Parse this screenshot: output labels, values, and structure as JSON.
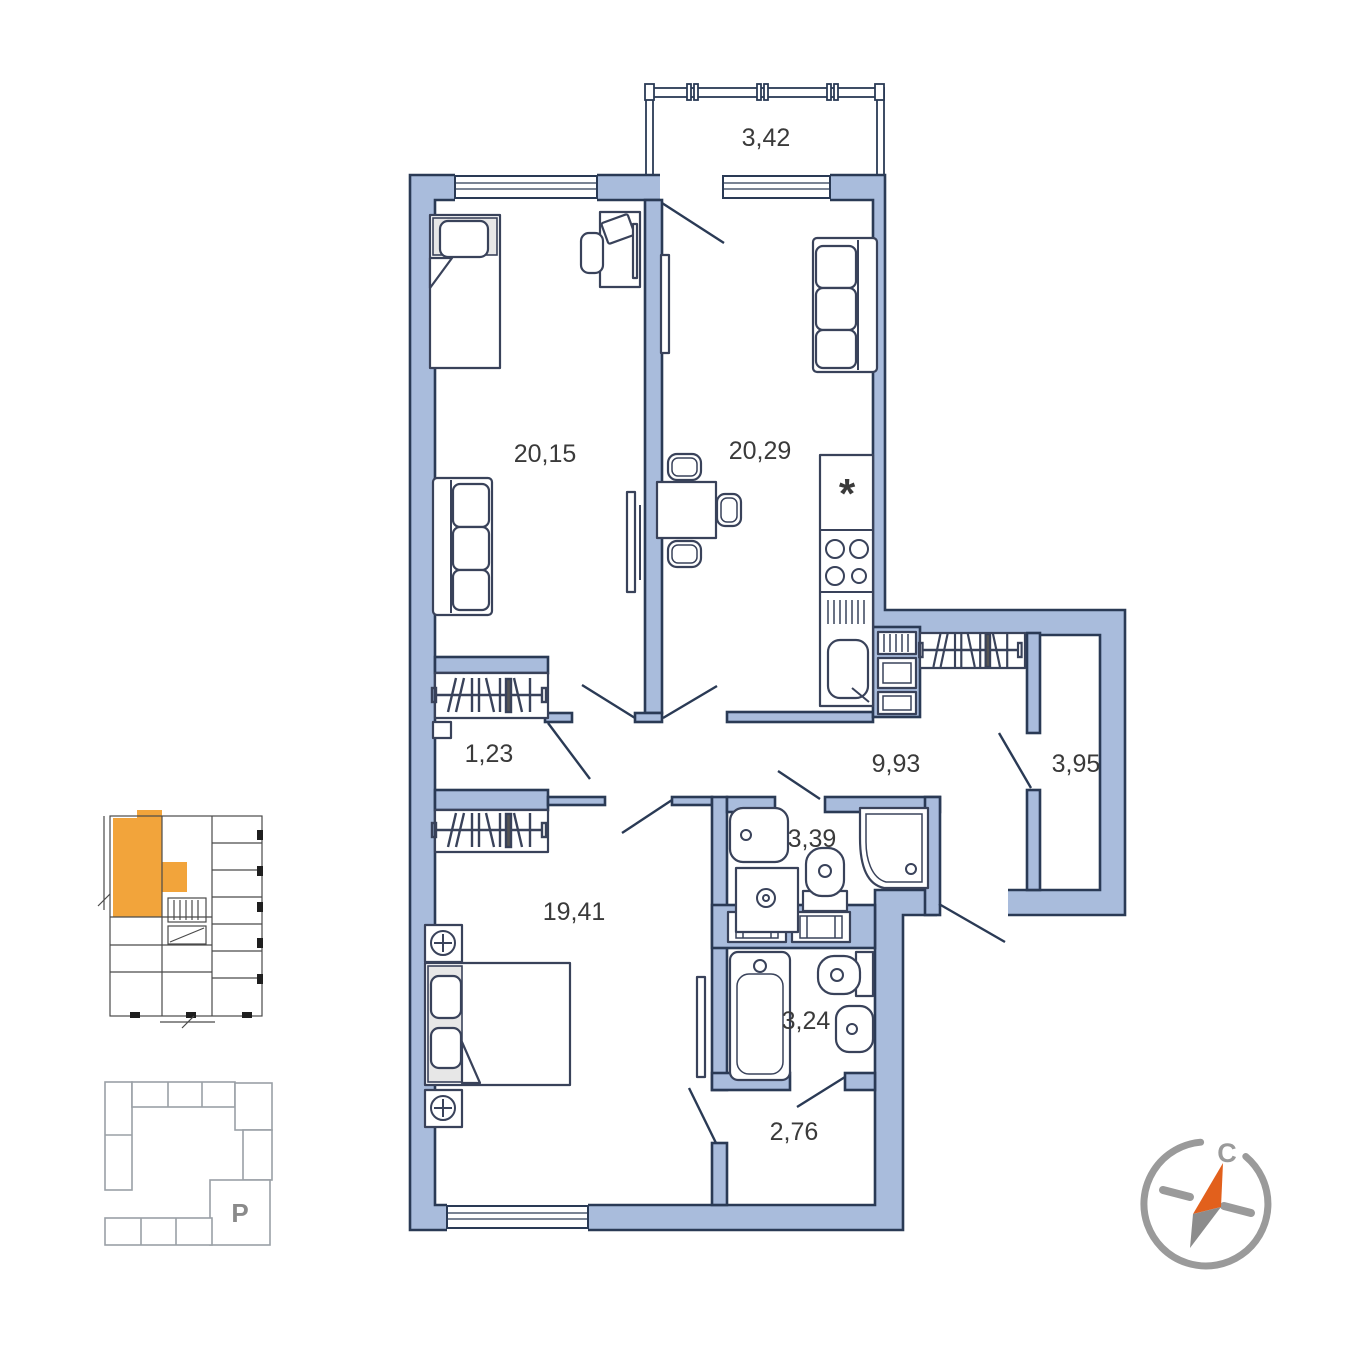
{
  "plan": {
    "rooms": [
      {
        "name": "balcony",
        "area": "3,42"
      },
      {
        "name": "bedroom-1",
        "area": "20,15"
      },
      {
        "name": "kitchen-living-room",
        "area": "20,29"
      },
      {
        "name": "corridor",
        "area": "1,23"
      },
      {
        "name": "hallway",
        "area": "9,93"
      },
      {
        "name": "storage",
        "area": "3,95"
      },
      {
        "name": "shower-room",
        "area": "3,39"
      },
      {
        "name": "bedroom-2",
        "area": "19,41"
      },
      {
        "name": "bathroom",
        "area": "3,24"
      },
      {
        "name": "entry-hall",
        "area": "2,76"
      }
    ],
    "symbols": {
      "fridge": "*"
    },
    "colors": {
      "wall": "#A9BCDC",
      "outline": "#2A3A55",
      "furniture_outline": "#39425A",
      "text": "#3A3A3A"
    }
  },
  "minimap": {
    "highlight_color": "#F2A43B",
    "outline_color": "#4A4A4A"
  },
  "siteplan": {
    "parking_label": "P",
    "outline_color": "#9AA0A6",
    "highlight_color": "#F2A43B"
  },
  "compass": {
    "north_label": "С",
    "ring_color": "#9A9A9A",
    "needle_north_color": "#E2601C",
    "needle_south_color": "#8C8C8C"
  }
}
